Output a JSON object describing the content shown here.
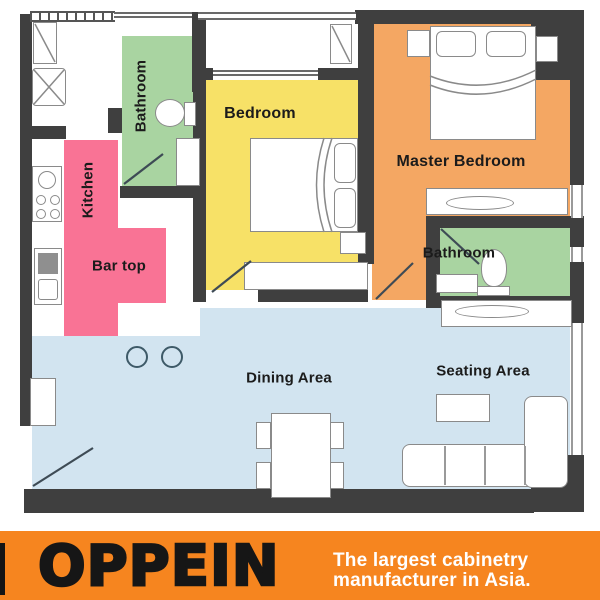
{
  "banner": {
    "brand": "OPPEIN",
    "tagline_line1": "The largest cabinetry",
    "tagline_line2": "manufacturer in Asia."
  },
  "rooms": {
    "bathroom_left": {
      "label": "Bathroom",
      "color": "#A9D4A1"
    },
    "kitchen": {
      "label": "Kitchen",
      "color": "#F97395"
    },
    "bar_top": {
      "label": "Bar top",
      "color": "#F97395"
    },
    "bedroom": {
      "label": "Bedroom",
      "color": "#F7E167"
    },
    "master_bedroom": {
      "label": "Master Bedroom",
      "color": "#F4A763"
    },
    "bathroom_right": {
      "label": "Bathroom",
      "color": "#A9D4A1"
    },
    "dining_area": {
      "label": "Dining Area",
      "color": "#D2E4F0"
    },
    "seating_area": {
      "label": "Seating Area",
      "color": "#D2E4F0"
    }
  },
  "colors": {
    "wall": "#3F3F3F",
    "banner_orange": "#F6851F",
    "furniture_line": "#8A8A8A",
    "door_line": "#3E4B55",
    "label_text": "#1B1B1B"
  }
}
